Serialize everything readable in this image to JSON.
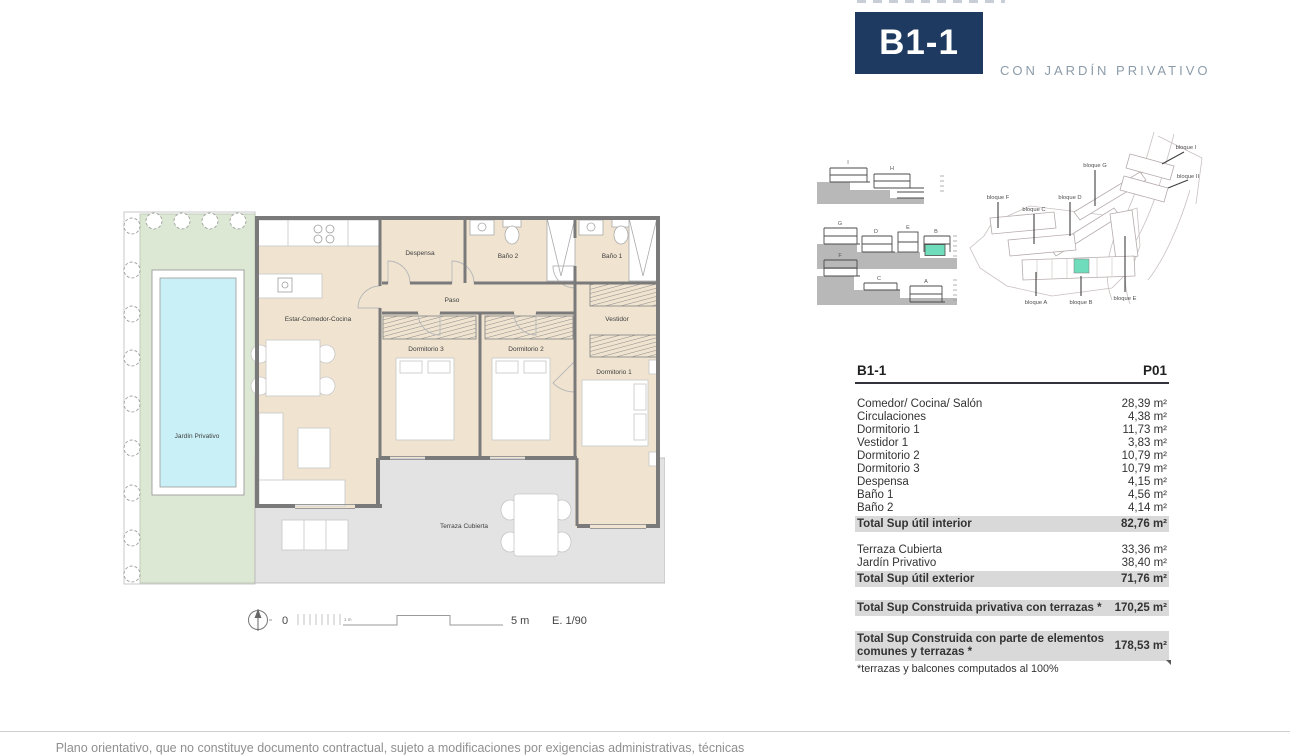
{
  "header": {
    "unit": "B1-1",
    "subtitle": "CON JARDÍN PRIVATIVO"
  },
  "site_sections": {
    "row1": [
      "I",
      "H"
    ],
    "row2": [
      "G",
      "D",
      "E",
      "B"
    ],
    "row3": [
      "F",
      "C",
      "A"
    ]
  },
  "site_map": {
    "labels": {
      "f": "bloque F",
      "c": "bloque C",
      "d": "bloque D",
      "g": "bloque G",
      "i": "bloque I",
      "ii": "bloque II",
      "a": "bloque A",
      "b": "bloque B",
      "e": "bloque E"
    }
  },
  "floorplan": {
    "labels": {
      "despensa": "Despensa",
      "bano2": "Baño 2",
      "bano1": "Baño 1",
      "paso": "Paso",
      "estar": "Estar-Comedor-Cocina",
      "dorm3": "Dormitorio 3",
      "dorm2": "Dormitorio 2",
      "vestidor": "Vestidor",
      "dorm1": "Dormitorio 1",
      "jardin": "Jardín Privativo",
      "terraza": "Terraza Cubierta"
    }
  },
  "scalebar": {
    "zero": "0",
    "one": "1 m",
    "five": "5 m",
    "scale": "E. 1/90"
  },
  "table": {
    "col_left": "B1-1",
    "col_right": "P01",
    "interior": [
      {
        "label": "Comedor/ Cocina/ Salón",
        "value": "28,39 m²"
      },
      {
        "label": "Circulaciones",
        "value": "4,38 m²"
      },
      {
        "label": "Dormitorio 1",
        "value": "11,73 m²"
      },
      {
        "label": "Vestidor 1",
        "value": "3,83 m²"
      },
      {
        "label": "Dormitorio 2",
        "value": "10,79 m²"
      },
      {
        "label": "Dormitorio 3",
        "value": "10,79 m²"
      },
      {
        "label": "Despensa",
        "value": "4,15 m²"
      },
      {
        "label": "Baño 1",
        "value": "4,56 m²"
      },
      {
        "label": "Baño 2",
        "value": "4,14 m²"
      }
    ],
    "total_interior": {
      "label": "Total Sup útil interior",
      "value": "82,76 m²"
    },
    "exterior": [
      {
        "label": "Terraza Cubierta",
        "value": "33,36 m²"
      },
      {
        "label": "Jardín Privativo",
        "value": "38,40 m²"
      }
    ],
    "total_exterior": {
      "label": "Total Sup útil exterior",
      "value": "71,76 m²"
    },
    "total_privativa": {
      "label": "Total Sup Construida privativa con terrazas *",
      "value": "170,25 m²"
    },
    "total_comunes": {
      "label": "Total Sup Construida con parte de elementos comunes y terrazas *",
      "value": "178,53 m²"
    },
    "footnote": "*terrazas y balcones computados al 100%"
  },
  "footer": "Plano orientativo, que no constituye documento contractual, sujeto a modificaciones por exigencias administrativas, técnicas o jurídicas",
  "colors": {
    "navy": "#1E3A60",
    "highlight_teal": "#6FDCBB",
    "floor_beige": "#F0E4D1",
    "garden_green": "#DDE8D4",
    "pool_cyan": "#C9F0F6",
    "terrace_gray": "#E3E3E3",
    "wall_gray": "#7A7A7A",
    "total_row_bg": "#D9D9D9"
  }
}
